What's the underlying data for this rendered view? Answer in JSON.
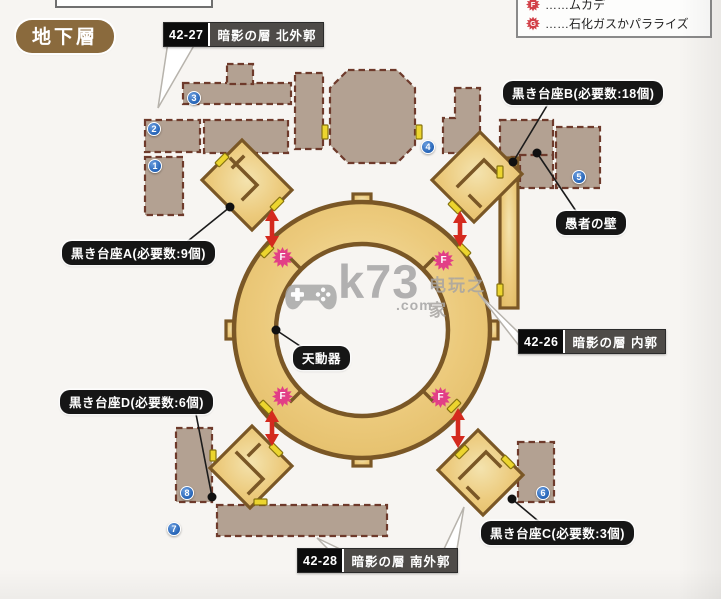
{
  "page": {
    "floor_badge": "地下層",
    "watermark": {
      "brand": "k73",
      "tld": ".com",
      "site_name": "电玩之家"
    }
  },
  "legend": {
    "items": [
      {
        "icon": "F",
        "label": "……ムカデ"
      },
      {
        "icon": "G",
        "label": "……石化ガスかパラライズ"
      }
    ]
  },
  "sections": [
    {
      "code": "42-27",
      "name": "暗影の層 北外郭"
    },
    {
      "code": "42-26",
      "name": "暗影の層 内郭"
    },
    {
      "code": "42-28",
      "name": "暗影の層 南外郭"
    }
  ],
  "callouts": {
    "pedestal_a": "黒き台座A(必要数:9個)",
    "pedestal_b": "黒き台座B(必要数:18個)",
    "pedestal_c": "黒き台座C(必要数:3個)",
    "pedestal_d": "黒き台座D(必要数:6個)",
    "fools_wall": "愚者の壁",
    "tendoki": "天動器"
  },
  "markers": {
    "numbered": [
      "1",
      "2",
      "3",
      "4",
      "5",
      "6",
      "7",
      "8"
    ],
    "enemy_letter": "F"
  },
  "colors": {
    "map_gold": "#ecca7c",
    "room_taupe": "#b3a192",
    "arrow_red": "#d42a1e",
    "marker_blue": "#2160b4",
    "enemy_pink": "#e23f86",
    "legend_red": "#d24048",
    "badge_brown": "#8a6a3d"
  }
}
